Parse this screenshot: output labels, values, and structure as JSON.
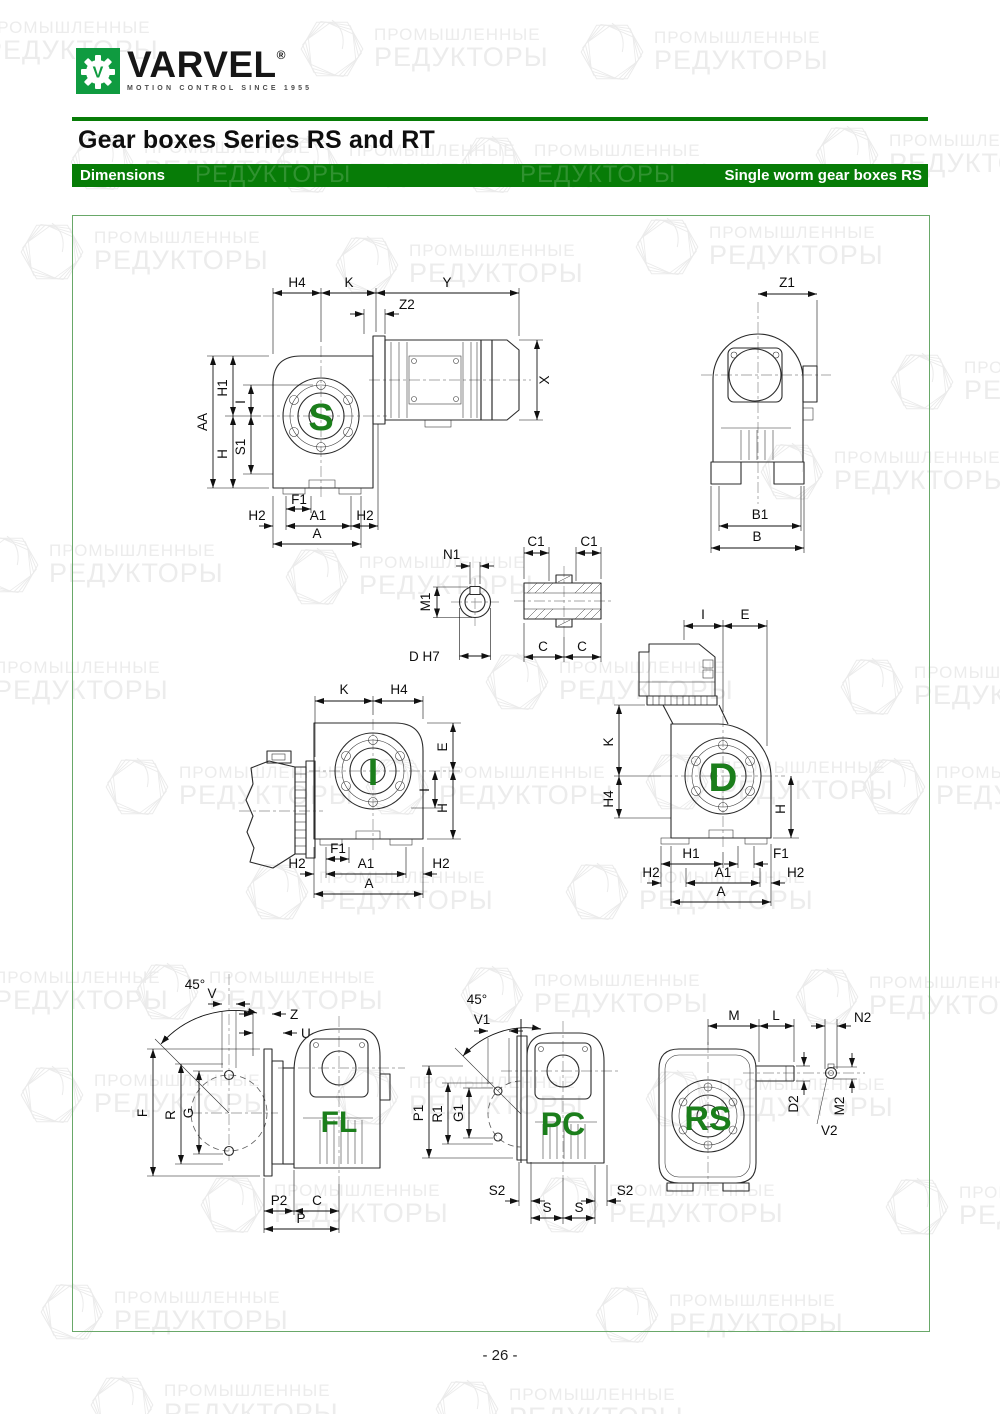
{
  "header": {
    "logo": {
      "brand": "VARVEL",
      "registered": "®",
      "tagline": "MOTION CONTROL SINCE 1955"
    },
    "title": "Gear boxes Series RS and RT",
    "bar": {
      "left": "Dimensions",
      "right": "Single worm gear boxes RS"
    }
  },
  "watermark": {
    "line1": "ПРОМЫШЛЕННЫЕ",
    "line2": "РЕДУКТОРЫ"
  },
  "footer": {
    "page_number": "- 26 -"
  },
  "colors": {
    "brand_green": "#0f9b40",
    "bar_green": "#077c07",
    "letter_green": "#1b7e1b",
    "box_border_green": "#69a869"
  },
  "figures": {
    "s": {
      "letter": "S",
      "h4": "H4",
      "k": "K",
      "y": "Y",
      "z2": "Z2",
      "x": "X",
      "aa": "AA",
      "h1": "H1",
      "i": "I",
      "h": "H",
      "s1": "S1",
      "f1": "F1",
      "h2": "H2",
      "a1": "A1",
      "a": "A"
    },
    "rear": {
      "z1": "Z1",
      "b1": "B1",
      "b": "B"
    },
    "bore": {
      "n1": "N1",
      "m1": "M1",
      "d": "D H7"
    },
    "hollow_shaft": {
      "c1": "C1",
      "c": "C"
    },
    "i": {
      "letter": "I",
      "k": "K",
      "h4": "H4",
      "e": "E",
      "i": "I",
      "h": "H",
      "f1": "F1",
      "h2": "H2",
      "a1": "A1",
      "a": "A"
    },
    "d": {
      "letter": "D",
      "i": "I",
      "e": "E",
      "k": "K",
      "h4": "H4",
      "h": "H",
      "h1": "H1",
      "f1": "F1",
      "h2": "H2",
      "a1": "A1",
      "a": "A"
    },
    "fl": {
      "letter": "FL",
      "angle": "45°",
      "v": "V",
      "z": "Z",
      "u": "U",
      "f": "F",
      "r": "R",
      "g": "G",
      "p2": "P2",
      "c": "C",
      "p": "P"
    },
    "pc": {
      "letter": "PC",
      "angle": "45°",
      "v1": "V1",
      "p1": "P1",
      "r1": "R1",
      "g1": "G1",
      "s2": "S2",
      "s": "S"
    },
    "rs": {
      "letter": "RS",
      "m": "M",
      "l": "L",
      "n2": "N2",
      "d2": "D2",
      "m2": "M2",
      "v2": "V2"
    }
  }
}
